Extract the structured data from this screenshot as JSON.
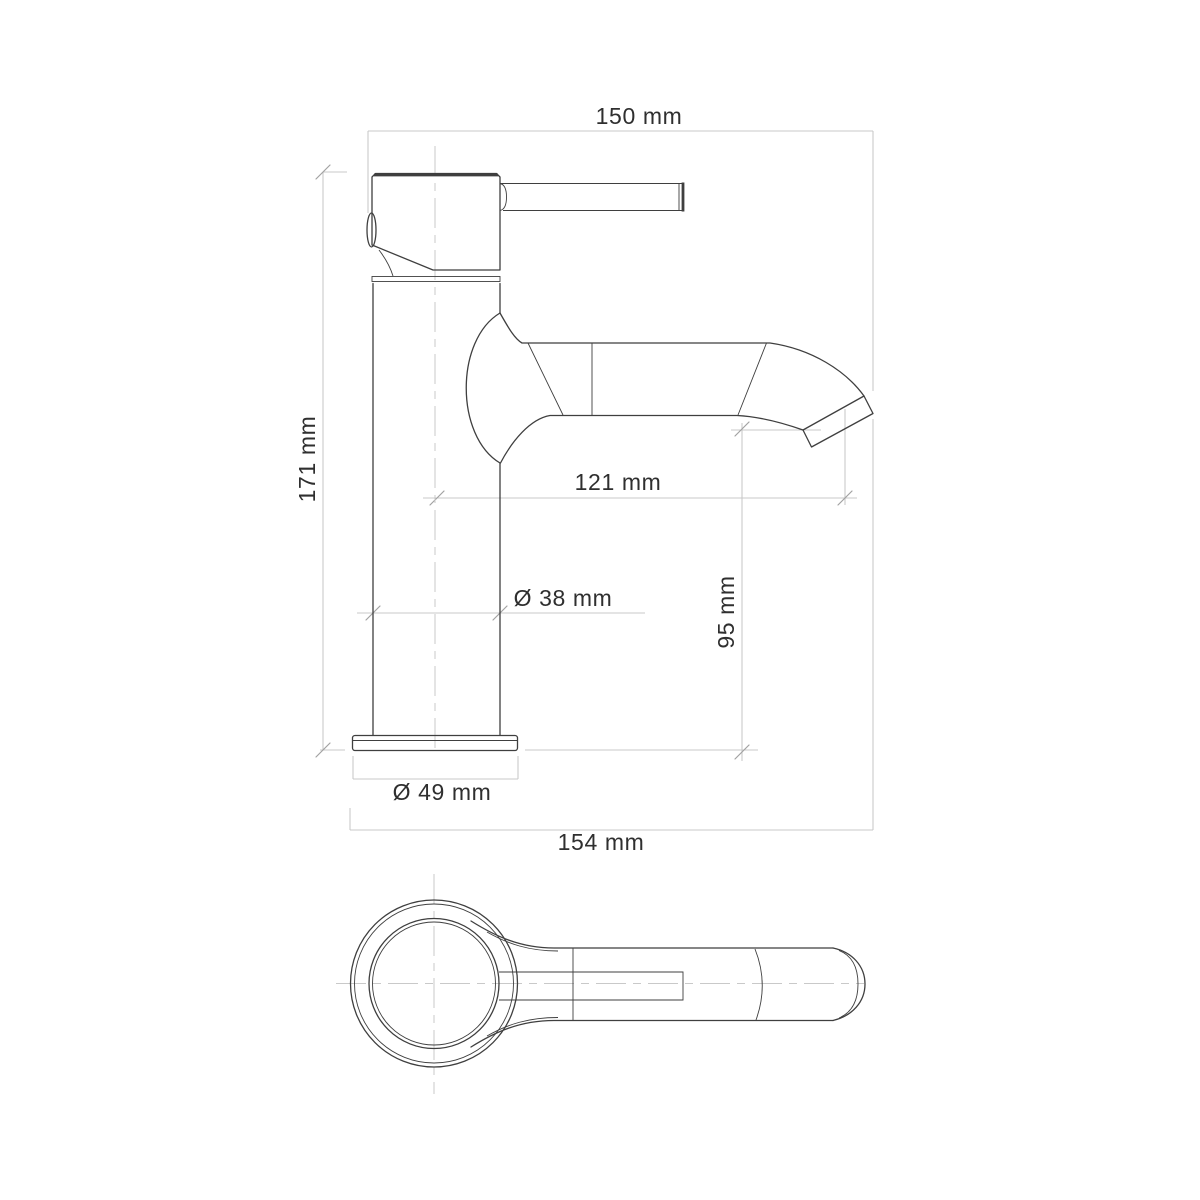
{
  "document_title": "Faucet dimensional drawing",
  "colors": {
    "background": "#ffffff",
    "outline": "#3f3f3f",
    "dimension": "#c9c9c9",
    "tick": "#a2a2a2",
    "text": "#2f2f2f"
  },
  "dimensions": {
    "overall_width_top": "150 mm",
    "overall_height": "171 mm",
    "spout_reach": "121 mm",
    "body_diameter": "Ø 38 mm",
    "spout_height": "95 mm",
    "base_diameter": "Ø 49 mm",
    "overall_width_bottom": "154 mm"
  }
}
